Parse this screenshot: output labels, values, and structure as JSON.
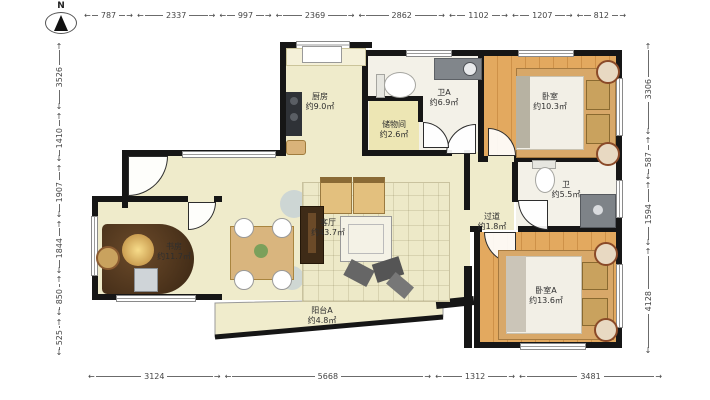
{
  "north": {
    "label": "N"
  },
  "dimensions": {
    "top": [
      "787",
      "2337",
      "997",
      "2369",
      "2862",
      "1102",
      "1207",
      "812"
    ],
    "bottom": [
      "3124",
      "5668",
      "1312",
      "3481"
    ],
    "left": [
      "3526",
      "1410",
      "1907",
      "1844",
      "850",
      "525"
    ],
    "right": [
      "3306",
      "587",
      "1594",
      "4128"
    ]
  },
  "rooms": {
    "kitchen": {
      "name": "厨房",
      "area": "约9.0㎡"
    },
    "bath_a": {
      "name": "卫A",
      "area": "约6.9㎡"
    },
    "storage": {
      "name": "储物间",
      "area": "约2.6㎡"
    },
    "bedroom": {
      "name": "卧室",
      "area": "约10.3㎡"
    },
    "bath": {
      "name": "卫",
      "area": "约5.5㎡"
    },
    "hallway": {
      "name": "过道",
      "area": "约1.8㎡"
    },
    "living": {
      "name": "客厅",
      "area": "约43.7㎡"
    },
    "study": {
      "name": "书房",
      "area": "约11.7㎡"
    },
    "bedroom_a": {
      "name": "卧室A",
      "area": "约13.6㎡"
    },
    "balcony_a": {
      "name": "阳台A",
      "area": "约4.8㎡"
    }
  },
  "colors": {
    "wall": "#161616",
    "floor_cream": "#EFEBCB",
    "floor_wood": "#E3A95F",
    "floor_wood_line": "#CE9148",
    "floor_storage": "#EDE6B4",
    "floor_bath": "#F3F1E8",
    "dim_text": "#454545",
    "furniture_tan": "#D9B37A",
    "furniture_dark": "#3E2B17",
    "fixture_gray": "#81868B"
  }
}
